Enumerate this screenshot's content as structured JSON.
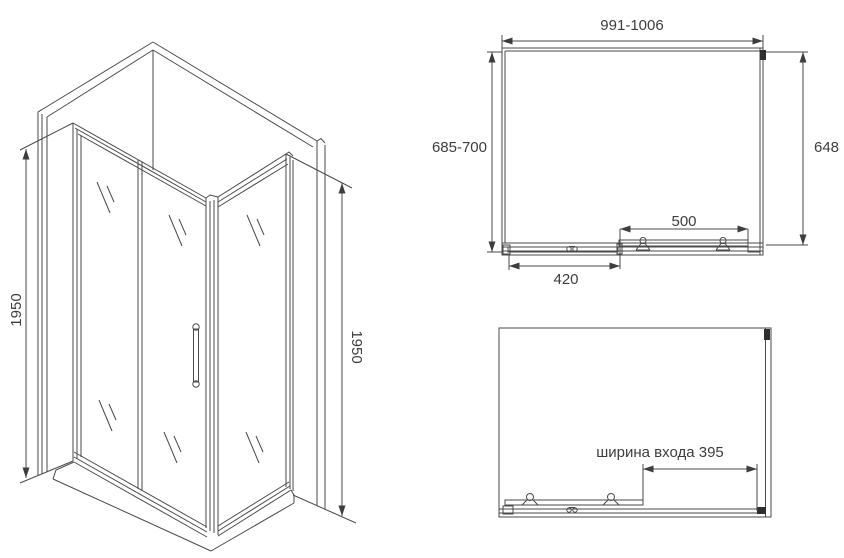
{
  "drawing": {
    "subject": "corner shower enclosure technical drawing",
    "colors": {
      "line": "#4a4a4a",
      "text": "#3d3d3d",
      "background": "#ffffff"
    }
  },
  "dims": {
    "height_left": "1950",
    "height_right": "1950",
    "width_range": "991-1006",
    "depth_range": "685-700",
    "side_depth": "648",
    "door_width": "500",
    "fixed_width": "420",
    "entrance_width": "ширина входа 395"
  }
}
